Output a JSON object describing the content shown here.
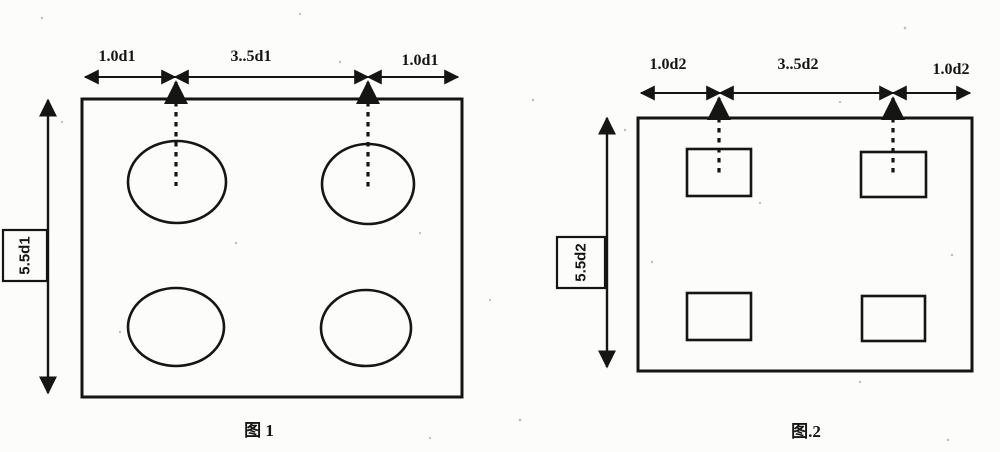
{
  "sheet": {
    "paper_color": "#fcfcfa",
    "ink_color": "#151515"
  },
  "figure1": {
    "caption": "图 1",
    "dim_top_left": "1.0d1",
    "dim_top_middle": "3..5d1",
    "dim_top_right": "1.0d1",
    "dim_side": "5.5d1"
  },
  "figure2": {
    "caption": "图.2",
    "dim_top_left": "1.0d2",
    "dim_top_middle": "3..5d2",
    "dim_top_right": "1.0d2",
    "dim_side": "5.5d2"
  }
}
